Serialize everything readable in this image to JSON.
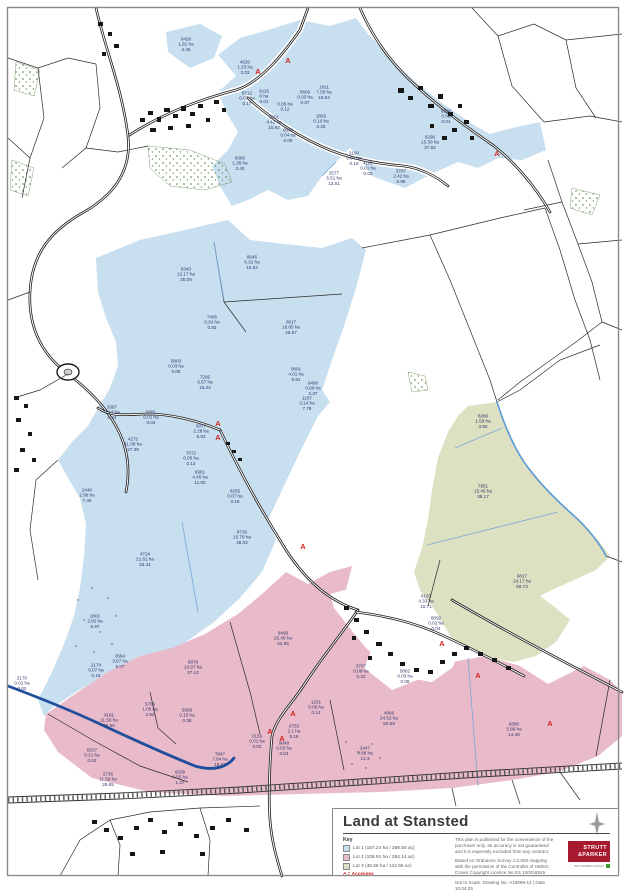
{
  "title_block": {
    "title": "Land at Stansted",
    "key": {
      "heading": "Key",
      "lots": [
        {
          "label": "Lot 1 (157.24 ha / 388.55 ac)",
          "color": "#c8dff0"
        },
        {
          "label": "Lot 2 (106.91 ha / 264.14 ac)",
          "color": "#e9bac9"
        },
        {
          "label": "Lot 3 (45.55 ha / 112.55 ac)",
          "color": "#dde0c1"
        }
      ],
      "access_note": "A = Accesses"
    },
    "disclaimer": "This plan is published for the convenience of the purchaser only. Its accuracy is not guaranteed and it is expressly excluded from any contract.",
    "os_credit": "Based on Ordnance Survey 1:2,500 mapping with the permission of the Controller of HMSO.  Crown Copyright Licence No ES 100018525",
    "drawing_info": "Not to Scale. Drawing No. V16999-12 | Date 10.04.25",
    "logo": {
      "line1": "STRUTT",
      "line2": "&PARKER",
      "sub": "BNP PARIBAS GROUP",
      "color": "#a6192e",
      "sub_color": "#3f9c35"
    }
  },
  "map": {
    "access_label": "A",
    "access_color": "#d42420",
    "label_color": "#31386e",
    "lot_colors": {
      "lot1": "#c8dff0",
      "lot2": "#e9bac9",
      "lot3": "#dde0c1"
    },
    "accesses": [
      {
        "x": 288,
        "y": 60
      },
      {
        "x": 258,
        "y": 71
      },
      {
        "x": 497,
        "y": 153
      },
      {
        "x": 218,
        "y": 423
      },
      {
        "x": 218,
        "y": 437
      },
      {
        "x": 303,
        "y": 546
      },
      {
        "x": 293,
        "y": 713
      },
      {
        "x": 270,
        "y": 731
      },
      {
        "x": 282,
        "y": 738
      },
      {
        "x": 442,
        "y": 643
      },
      {
        "x": 478,
        "y": 675
      },
      {
        "x": 550,
        "y": 723
      }
    ],
    "parcels": [
      {
        "id": "6428",
        "ha": "1.81 ha",
        "ac": "4.46",
        "x": 186,
        "y": 45
      },
      {
        "id": "4620",
        "ha": "1.23 ha",
        "ac": "3.03",
        "x": 245,
        "y": 68
      },
      {
        "id": "8712",
        "ha": "0.07 ha",
        "ac": "0.17",
        "x": 247,
        "y": 99
      },
      {
        "id": "9115",
        "ha": "0 ha",
        "ac": "0.01",
        "x": 264,
        "y": 97
      },
      {
        "id": "0809",
        "ha": "0.03 ha",
        "ac": "0.07",
        "x": 305,
        "y": 98
      },
      {
        "id": "1611",
        "ha": "7.50 ha",
        "ac": "18.54",
        "x": 324,
        "y": 93
      },
      {
        "id": "",
        "ha": "0.05 ha",
        "ac": "0.12",
        "x": 285,
        "y": 110
      },
      {
        "id": "1893",
        "ha": "0.10 ha",
        "ac": "0.25",
        "x": 321,
        "y": 122
      },
      {
        "id": "9801",
        "ha": "4.42 ha",
        "ac": "10.92",
        "x": 274,
        "y": 123
      },
      {
        "id": "0998",
        "ha": "0.04 ha",
        "ac": "0.09",
        "x": 288,
        "y": 136
      },
      {
        "id": "8208",
        "ha": "0 ha",
        "ac": "0.01",
        "x": 446,
        "y": 117
      },
      {
        "id": "6290",
        "ha": "15.30 ha",
        "ac": "37.82",
        "x": 430,
        "y": 143
      },
      {
        "id": "3190",
        "ha": "0.04 ha",
        "ac": "0.10",
        "x": 354,
        "y": 159
      },
      {
        "id": "4181",
        "ha": "0.01 ha",
        "ac": "0.02",
        "x": 368,
        "y": 169
      },
      {
        "id": "8383",
        "ha": "1.38 ha",
        "ac": "3.40",
        "x": 240,
        "y": 164
      },
      {
        "id": "2577",
        "ha": "5.51 ha",
        "ac": "13.61",
        "x": 334,
        "y": 179
      },
      {
        "id": "3787",
        "ha": "2.42 ha",
        "ac": "5.98",
        "x": 401,
        "y": 177
      },
      {
        "id": "8645",
        "ha": "6.32 ha",
        "ac": "15.62",
        "x": 252,
        "y": 263
      },
      {
        "id": "8340",
        "ha": "12.17 ha",
        "ac": "30.08",
        "x": 186,
        "y": 275
      },
      {
        "id": "0917",
        "ha": "18.85 ha",
        "ac": "46.57",
        "x": 291,
        "y": 328
      },
      {
        "id": "7405",
        "ha": "0.34 ha",
        "ac": "0.83",
        "x": 212,
        "y": 323
      },
      {
        "id": "5803",
        "ha": "0.03 ha",
        "ac": "0.08",
        "x": 176,
        "y": 367
      },
      {
        "id": "0801",
        "ha": "4.01 ha",
        "ac": "9.91",
        "x": 296,
        "y": 375
      },
      {
        "id": "7295",
        "ha": "6.57 ha",
        "ac": "16.22",
        "x": 205,
        "y": 383
      },
      {
        "id": "9490",
        "ha": "0.96 ha",
        "ac": "2.37",
        "x": 313,
        "y": 389
      },
      {
        "id": "1187",
        "ha": "3.14 ha",
        "ac": "7.76",
        "x": 307,
        "y": 404
      },
      {
        "id": "3387",
        "ha": "0.14 ha",
        "ac": "0.34",
        "x": 112,
        "y": 413
      },
      {
        "id": "5881",
        "ha": "0.01 ha",
        "ac": "0.04",
        "x": 151,
        "y": 418
      },
      {
        "id": "6977",
        "ha": "2.28 ha",
        "ac": "5.63",
        "x": 201,
        "y": 432
      },
      {
        "id": "4272",
        "ha": "11.08 ha",
        "ac": "27.39",
        "x": 133,
        "y": 445
      },
      {
        "id": "7072",
        "ha": "0.05 ha",
        "ac": "0.13",
        "x": 191,
        "y": 459
      },
      {
        "id": "6961",
        "ha": "4.45 ha",
        "ac": "11.00",
        "x": 200,
        "y": 478
      },
      {
        "id": "8255",
        "ha": "0.07 ha",
        "ac": "0.18",
        "x": 235,
        "y": 497
      },
      {
        "id": "2446",
        "ha": "2.96 ha",
        "ac": "7.46",
        "x": 87,
        "y": 496
      },
      {
        "id": "8735",
        "ha": "15.79 ha",
        "ac": "39.02",
        "x": 242,
        "y": 538
      },
      {
        "id": "4724",
        "ha": "21.61 ha",
        "ac": "53.41",
        "x": 145,
        "y": 560
      },
      {
        "id": "2801",
        "ha": "2.82 ha",
        "ac": "6.97",
        "x": 95,
        "y": 622
      },
      {
        "id": "3664",
        "ha": "3.67 ha",
        "ac": "9.07",
        "x": 120,
        "y": 662
      },
      {
        "id": "2174",
        "ha": "0.07 ha",
        "ac": "0.18",
        "x": 96,
        "y": 671
      },
      {
        "id": "2170",
        "ha": "0.01 ha",
        "ac": "0.02",
        "x": 22,
        "y": 684
      },
      {
        "id": "8280",
        "ha": "1.58 ha",
        "ac": "3.90",
        "x": 483,
        "y": 422
      },
      {
        "id": "7951",
        "ha": "15.45 ha",
        "ac": "38.17",
        "x": 483,
        "y": 492
      },
      {
        "id": "9817",
        "ha": "24.17 ha",
        "ac": "59.73",
        "x": 522,
        "y": 582
      },
      {
        "id": "6103",
        "ha": "4.33 ha",
        "ac": "10.71",
        "x": 426,
        "y": 602
      },
      {
        "id": "6892",
        "ha": "0.02 ha",
        "ac": "0.04",
        "x": 436,
        "y": 624
      },
      {
        "id": "9496",
        "ha": "25.46 ha",
        "ac": "62.95",
        "x": 283,
        "y": 639
      },
      {
        "id": "6878",
        "ha": "10.97 ha",
        "ac": "27.12",
        "x": 193,
        "y": 668
      },
      {
        "id": "5766",
        "ha": "1.06 ha",
        "ac": "2.63",
        "x": 150,
        "y": 710
      },
      {
        "id": "5959",
        "ha": "0.15 ha",
        "ac": "0.38",
        "x": 187,
        "y": 716
      },
      {
        "id": "4181",
        "ha": "11.56 ha",
        "ac": "28.56",
        "x": 109,
        "y": 721
      },
      {
        "id": "5637",
        "ha": "0.21 ha",
        "ac": "0.53",
        "x": 92,
        "y": 756
      },
      {
        "id": "2736",
        "ha": "11.59 ha",
        "ac": "28.65",
        "x": 108,
        "y": 780
      },
      {
        "id": "7847",
        "ha": "7.64 ha",
        "ac": "18.87",
        "x": 220,
        "y": 760
      },
      {
        "id": "6339",
        "ha": "0.55 ha",
        "ac": "1.37",
        "x": 180,
        "y": 778
      },
      {
        "id": "0155",
        "ha": "0.01 ha",
        "ac": "0.03",
        "x": 257,
        "y": 742
      },
      {
        "id": "9648",
        "ha": "0.02 ha",
        "ac": "0.04",
        "x": 284,
        "y": 749
      },
      {
        "id": "0753",
        "ha": "2.1 ha",
        "ac": "5.18",
        "x": 294,
        "y": 732
      },
      {
        "id": "1261",
        "ha": "0.06 ha",
        "ac": "0.14",
        "x": 316,
        "y": 708
      },
      {
        "id": "3767",
        "ha": "0.09 ha",
        "ac": "0.22",
        "x": 361,
        "y": 672
      },
      {
        "id": "5882",
        "ha": "0.03 ha",
        "ac": "0.08",
        "x": 405,
        "y": 677
      },
      {
        "id": "4866",
        "ha": "24.52 ha",
        "ac": "60.59",
        "x": 389,
        "y": 719
      },
      {
        "id": "2447",
        "ha": "4.98 ha",
        "ac": "12.3",
        "x": 365,
        "y": 754
      },
      {
        "id": "9380",
        "ha": "5.86 ha",
        "ac": "14.48",
        "x": 514,
        "y": 730
      }
    ]
  }
}
